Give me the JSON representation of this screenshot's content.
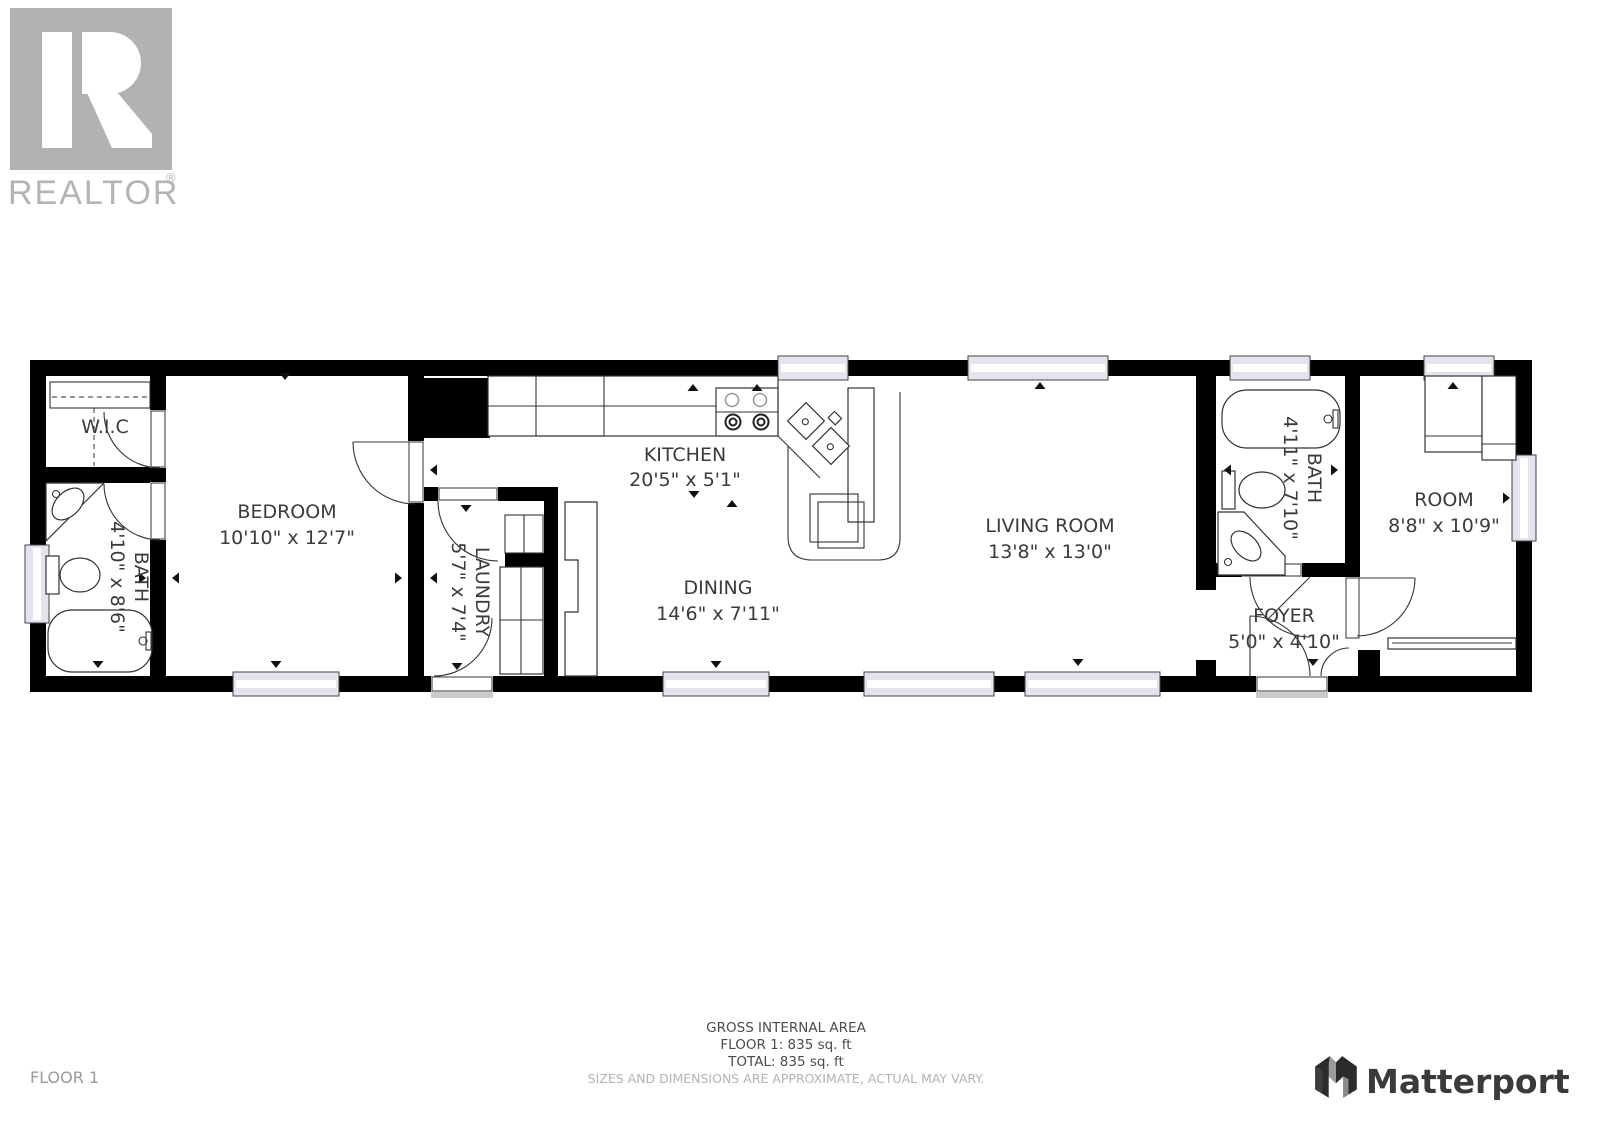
{
  "branding": {
    "realtor": {
      "label": "REALTOR",
      "reg": "®"
    },
    "matterport": {
      "label": "Matterport"
    }
  },
  "floorplan": {
    "rooms": {
      "wic": {
        "name": "W.I.C",
        "dims": ""
      },
      "bath_main": {
        "name": "BATH",
        "dims": "4'10\" x 8'6\""
      },
      "bedroom": {
        "name": "BEDROOM",
        "dims": "10'10\" x 12'7\""
      },
      "laundry": {
        "name": "LAUNDRY",
        "dims": "5'7\" x 7'4\""
      },
      "kitchen": {
        "name": "KITCHEN",
        "dims": "20'5\" x 5'1\""
      },
      "dining": {
        "name": "DINING",
        "dims": "14'6\" x 7'11\""
      },
      "living": {
        "name": "LIVING ROOM",
        "dims": "13'8\" x 13'0\""
      },
      "bath_second": {
        "name": "BATH",
        "dims": "4'11\" x 7'10\""
      },
      "foyer": {
        "name": "FOYER",
        "dims": "5'0\" x 4'10\""
      },
      "room": {
        "name": "ROOM",
        "dims": "8'8\" x 10'9\""
      }
    }
  },
  "footer": {
    "floor_label": "FLOOR 1",
    "gross_area_title": "GROSS INTERNAL AREA",
    "floor1_area": "FLOOR 1: 835 sq. ft",
    "total_area": "TOTAL: 835 sq. ft",
    "disclaimer": "SIZES AND DIMENSIONS ARE APPROXIMATE, ACTUAL MAY VARY."
  }
}
